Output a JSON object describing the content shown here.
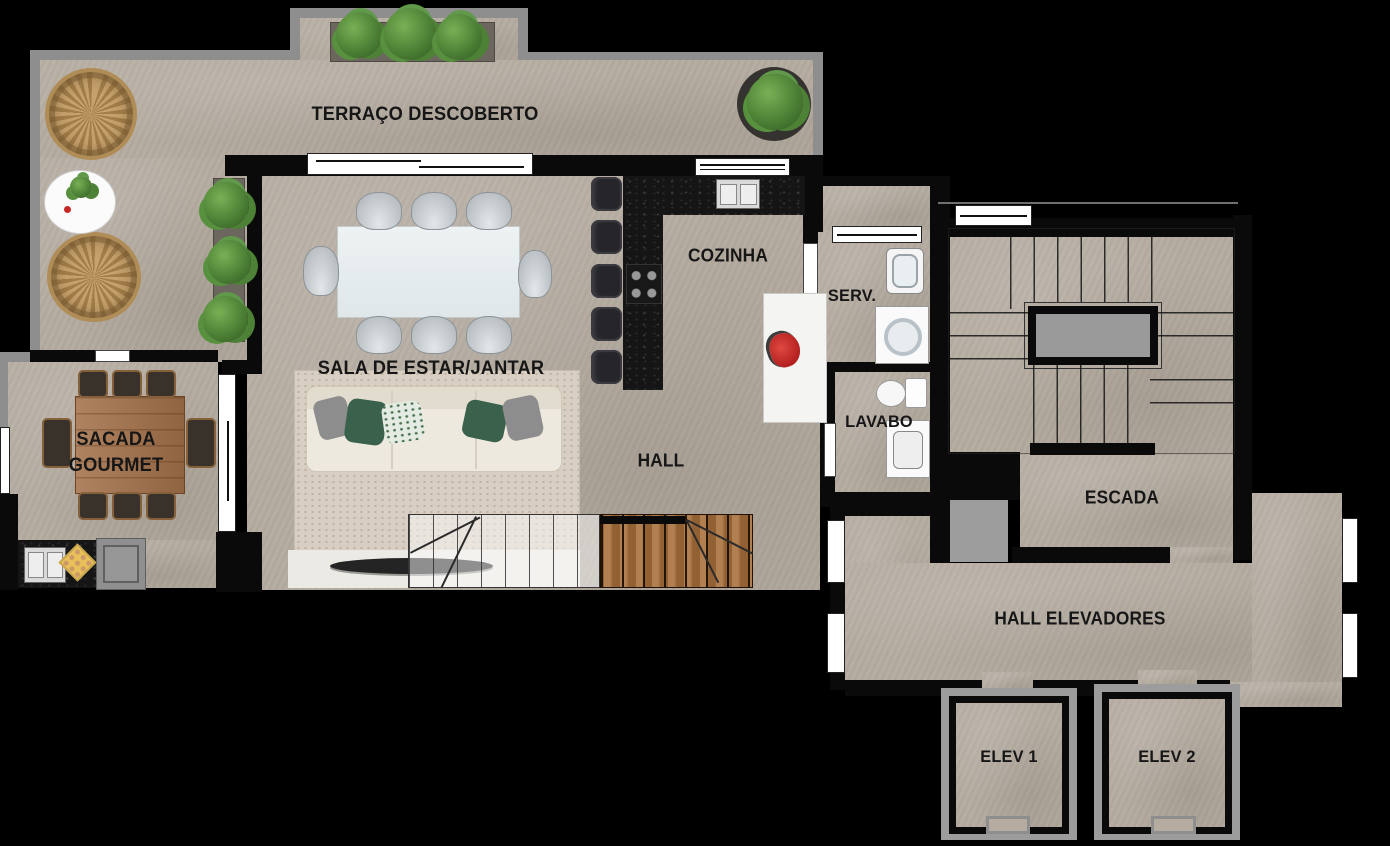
{
  "labels": {
    "terraco": "TERRAÇO DESCOBERTO",
    "cozinha": "COZINHA",
    "serv": "SERV.",
    "sala": "SALA DE ESTAR/JANTAR",
    "sacada_line1": "SACADA",
    "sacada_line2": "GOURMET",
    "lavabo": "LAVABO",
    "hall": "HALL",
    "escada": "ESCADA",
    "hall_elevadores": "HALL ELEVADORES",
    "elev1": "ELEV 1",
    "elev2": "ELEV 2"
  },
  "colors": {
    "bg": "#000000",
    "floor": "#b5aca1",
    "gray-zone": "#9d9d9d",
    "outer-wall": "#8e8e8e",
    "inner-wall": "#0a0a0a",
    "elev-frame": "#9c9c9c",
    "label": "#161616",
    "wood": "#a9713c",
    "plant": "#4d8136",
    "accent-red": "#c62828"
  }
}
